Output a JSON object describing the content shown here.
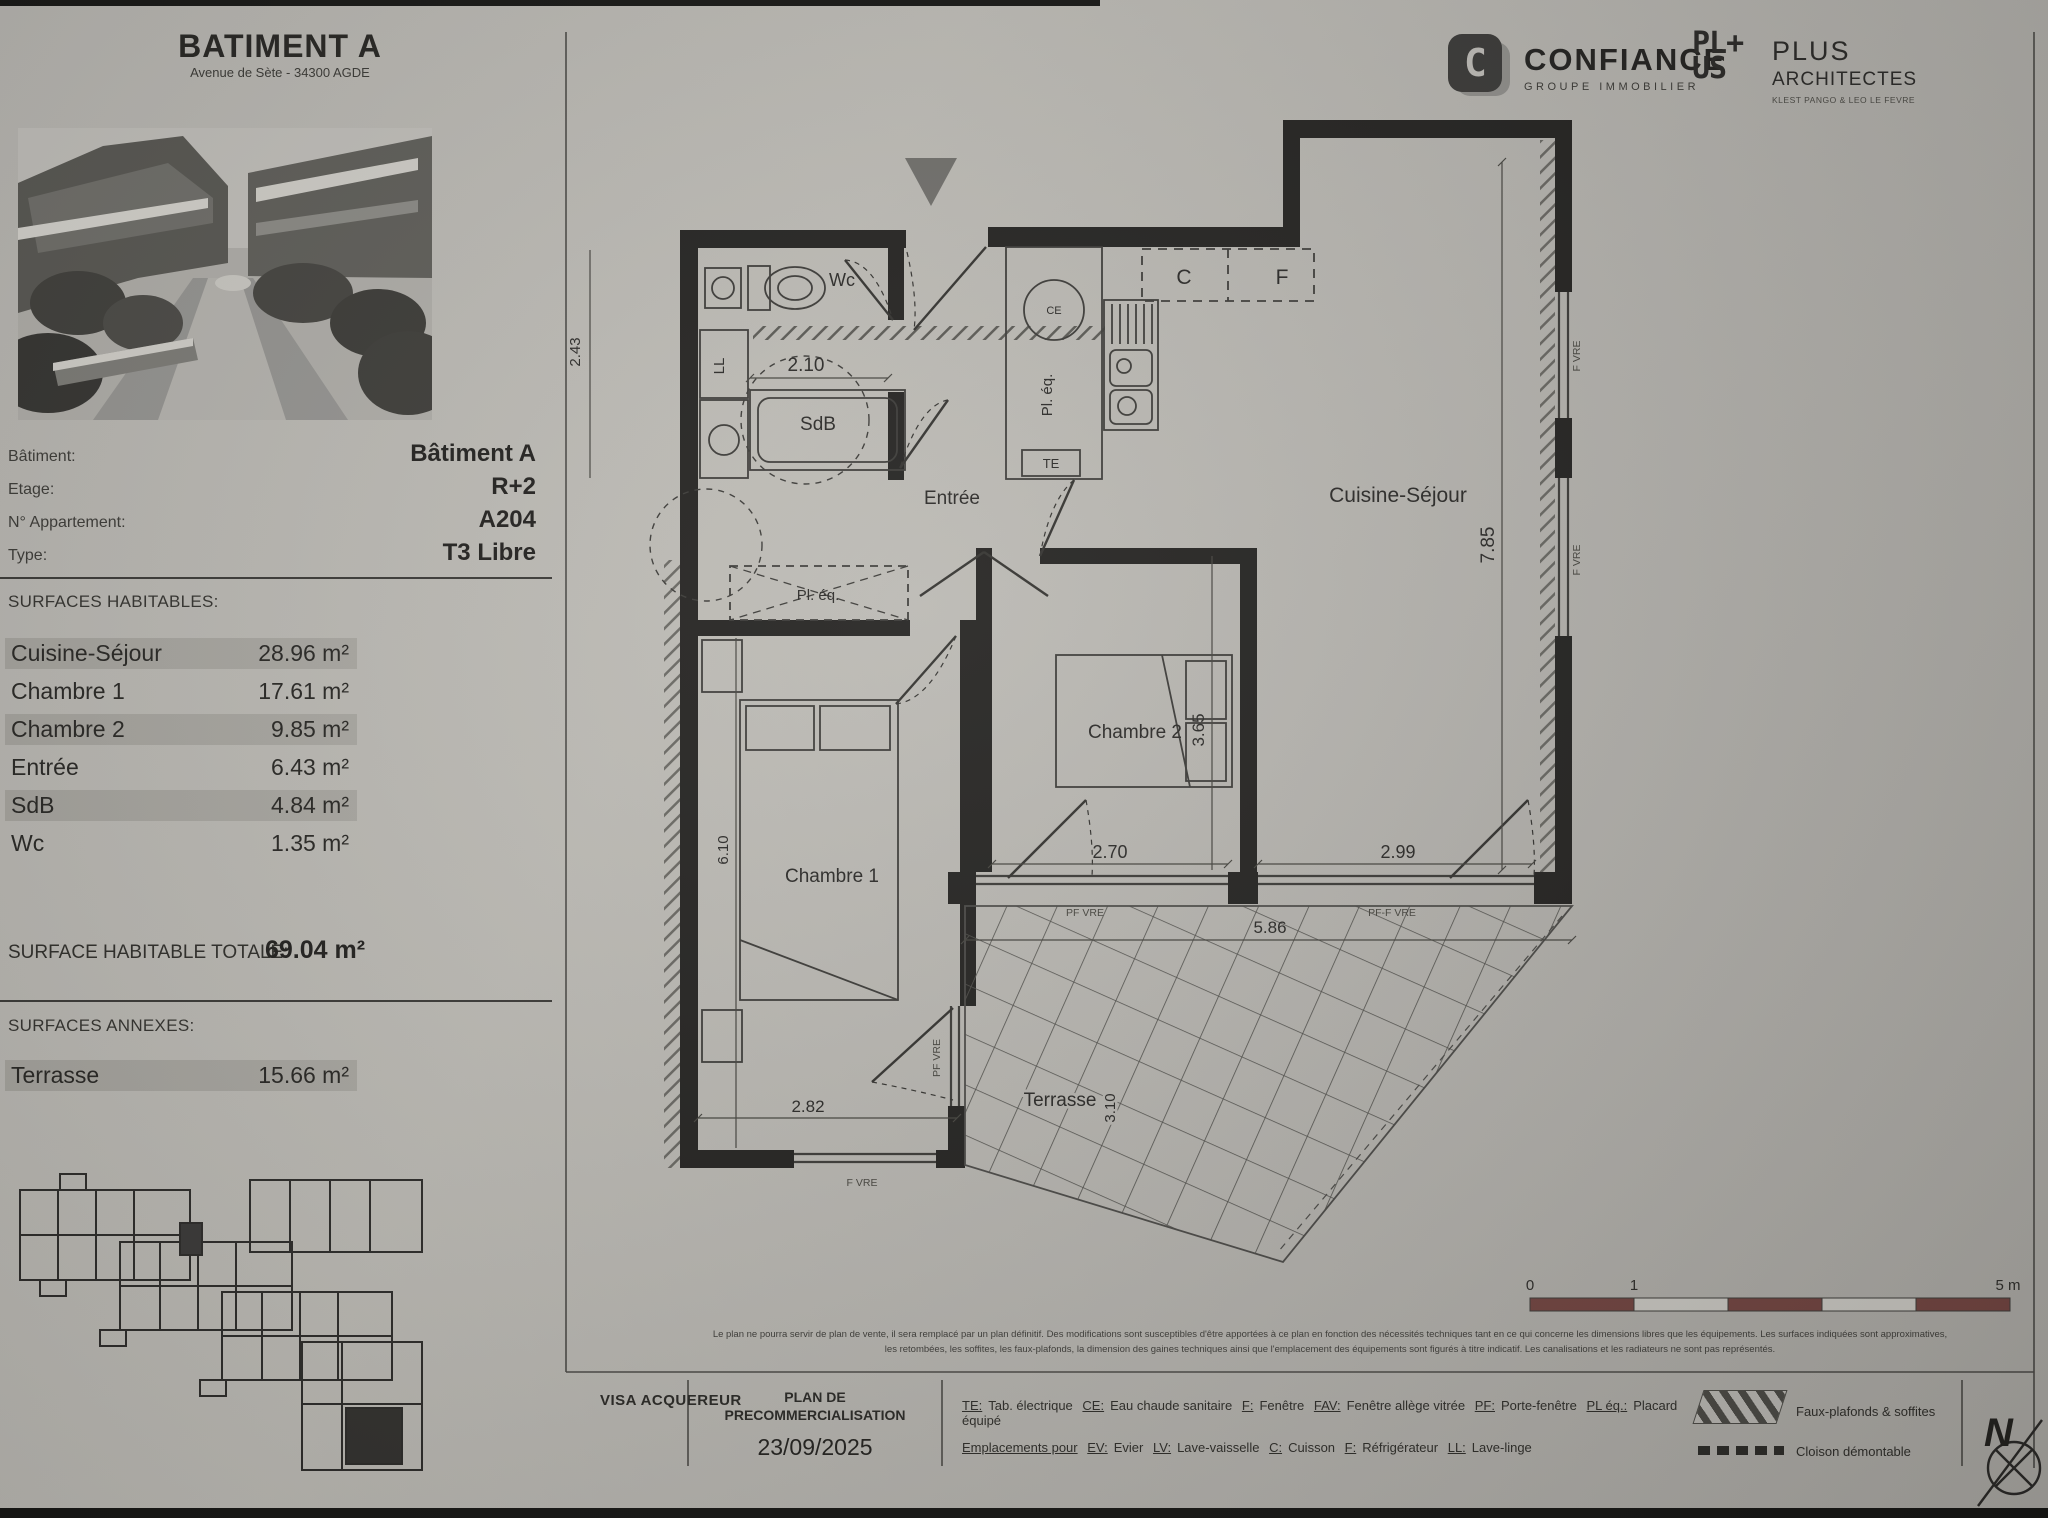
{
  "page": {
    "title": "BATIMENT A",
    "subtitle": "Avenue de Sète - 34300 AGDE"
  },
  "branding": {
    "confiance": {
      "letter": "C",
      "name": "CONFIANCE",
      "tagline": "GROUPE IMMOBILIER"
    },
    "plus": {
      "logo_line1": "PL+",
      "logo_line2": "US",
      "name": "PLUS",
      "name2": "ARCHITECTES",
      "tagline": "KLEST PANGO & LEO LE FEVRE"
    }
  },
  "unit_info": {
    "rows": [
      {
        "label": "Bâtiment:",
        "value": "Bâtiment A"
      },
      {
        "label": "Etage:",
        "value": "R+2"
      },
      {
        "label": "N° Appartement:",
        "value": "A204"
      },
      {
        "label": "Type:",
        "value": "T3 Libre"
      }
    ]
  },
  "surfaces": {
    "heading": "SURFACES HABITABLES:",
    "rows": [
      {
        "label": "Cuisine-Séjour",
        "value": "28.96 m²"
      },
      {
        "label": "Chambre 1",
        "value": "17.61 m²"
      },
      {
        "label": "Chambre 2",
        "value": "9.85 m²"
      },
      {
        "label": "Entrée",
        "value": "6.43 m²"
      },
      {
        "label": "SdB",
        "value": "4.84 m²"
      },
      {
        "label": "Wc",
        "value": "1.35 m²"
      }
    ],
    "total_label": "SURFACE HABITABLE TOTALE:",
    "total_value": "69.04 m²"
  },
  "annexes": {
    "heading": "SURFACES ANNEXES:",
    "rows": [
      {
        "label": "Terrasse",
        "value": "15.66 m²"
      }
    ]
  },
  "plan": {
    "labels": {
      "wc": "Wc",
      "sdb": "SdB",
      "entree": "Entrée",
      "cuisine_sejour": "Cuisine-Séjour",
      "chambre1": "Chambre 1",
      "chambre2": "Chambre 2",
      "terrasse": "Terrasse",
      "pl_eq_hall": "Pl. éq.",
      "pl_eq_kitchen": "Pl. éq.",
      "ll": "LL",
      "te": "TE",
      "ce": "CE",
      "cuisson": "C",
      "frigo": "F",
      "win_right_1": "F VRE",
      "win_right_2": "F VRE",
      "pf_chambre2": "PF VRE",
      "pf_sejour": "PF-F VRE",
      "win_chambre1": "F VRE",
      "pf_chambre1": "PF VRE"
    },
    "dims": {
      "sdb_width": "2.10",
      "sdb_depth": "2.43",
      "sejour_height": "7.85",
      "chambre2_depth": "3.65",
      "chambre2_width": "2.70",
      "sejour_width": "2.99",
      "chambre1_depth": "6.10",
      "chambre1_width": "2.82",
      "terrasse_width": "5.86",
      "terrasse_depth": "3.10"
    }
  },
  "scale": {
    "t0": "0",
    "t1": "1",
    "t5": "5 m"
  },
  "disclaimer": {
    "line1": "Le plan ne pourra servir de plan de vente, il sera remplacé par un plan définitif. Des modifications sont susceptibles d'être apportées à ce plan en fonction des nécessités techniques tant en ce qui concerne les dimensions libres que les équipements. Les surfaces indiquées sont approximatives,",
    "line2": "les retombées, les soffites, les faux-plafonds, la dimension des gaines techniques ainsi que l'emplacement des équipements sont figurés à titre indicatif. Les canalisations et les radiateurs ne sont pas représentés."
  },
  "footer": {
    "visa": "VISA ACQUEREUR",
    "plan_line1": "PLAN DE",
    "plan_line2": "PRECOMMERCIALISATION",
    "date": "23/09/2025",
    "legend1": [
      {
        "abbr": "TE:",
        "label": "Tab. électrique"
      },
      {
        "abbr": "CE:",
        "label": "Eau chaude sanitaire"
      },
      {
        "abbr": "F:",
        "label": "Fenêtre"
      },
      {
        "abbr": "FAV:",
        "label": "Fenêtre allège vitrée"
      },
      {
        "abbr": "PF:",
        "label": "Porte-fenêtre"
      },
      {
        "abbr": "PL éq.:",
        "label": "Placard équipé"
      }
    ],
    "swatch1_label": "Faux-plafonds & soffites",
    "legend2_intro": "Emplacements pour",
    "legend2": [
      {
        "abbr": "EV:",
        "label": "Evier"
      },
      {
        "abbr": "LV:",
        "label": "Lave-vaisselle"
      },
      {
        "abbr": "C:",
        "label": "Cuisson"
      },
      {
        "abbr": "F:",
        "label": "Réfrigérateur"
      },
      {
        "abbr": "LL:",
        "label": "Lave-linge"
      }
    ],
    "swatch2_label": "Cloison démontable",
    "north": "N"
  }
}
